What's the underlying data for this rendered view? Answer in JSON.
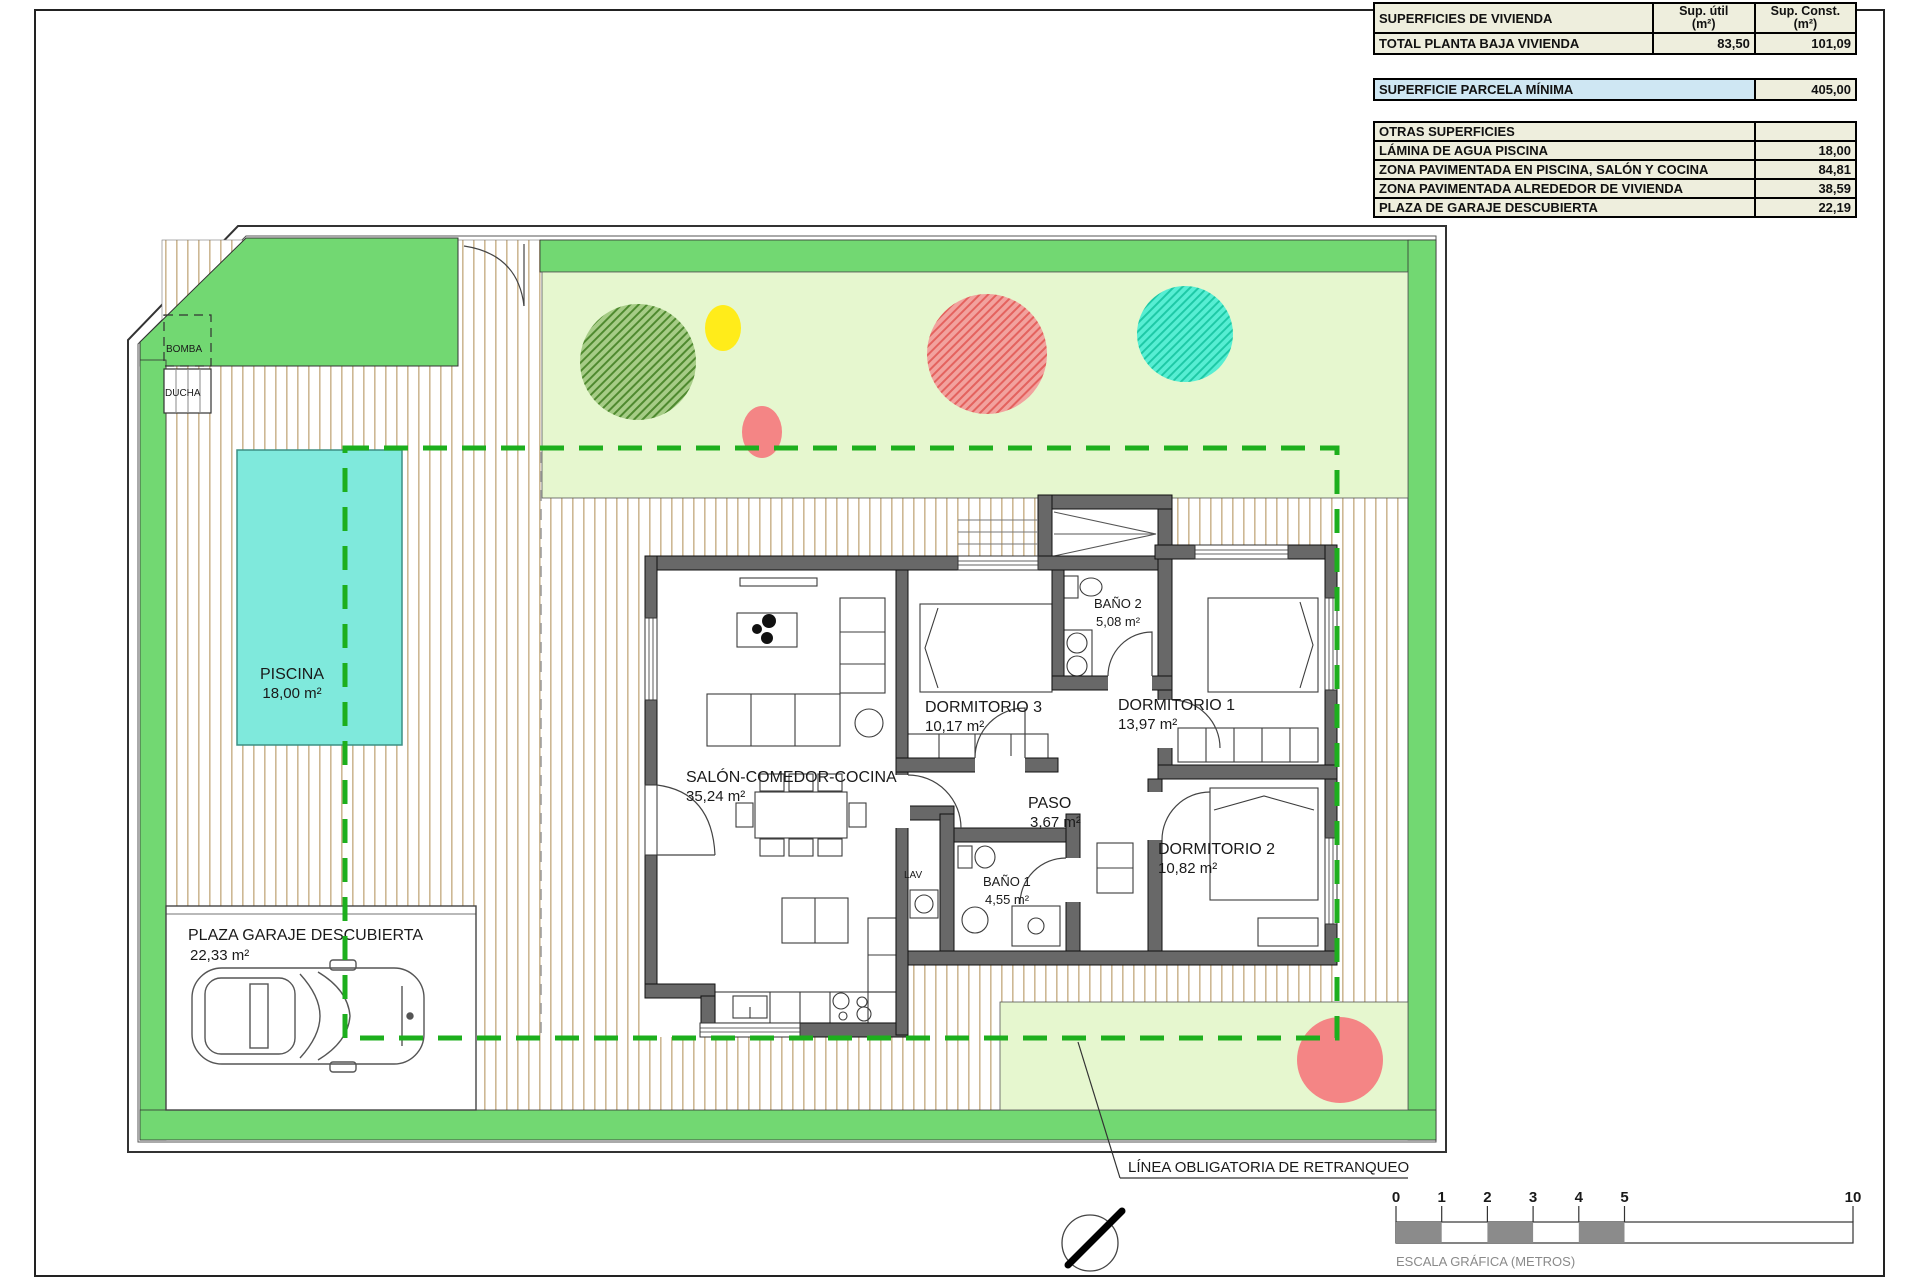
{
  "tables": {
    "vivienda": {
      "title": "SUPERFICIES DE VIVIENDA",
      "col_util_1": "Sup. útil",
      "col_util_2": "(m²)",
      "col_const_1": "Sup. Const.",
      "col_const_2": "(m²)",
      "total_label": "TOTAL PLANTA BAJA VIVIENDA",
      "total_util": "83,50",
      "total_const": "101,09"
    },
    "parcela": {
      "label": "SUPERFICIE PARCELA MÍNIMA",
      "value": "405,00"
    },
    "otras": {
      "title": "OTRAS SUPERFICIES",
      "rows": [
        {
          "label": "LÁMINA DE AGUA PISCINA",
          "value": "18,00"
        },
        {
          "label": "ZONA PAVIMENTADA EN PISCINA, SALÓN Y COCINA",
          "value": "84,81"
        },
        {
          "label": "ZONA PAVIMENTADA ALREDEDOR DE VIVIENDA",
          "value": "38,59"
        },
        {
          "label": "PLAZA DE GARAJE DESCUBIERTA",
          "value": "22,19"
        }
      ]
    }
  },
  "rooms": {
    "salon": {
      "name": "SALÓN-COMEDOR-COCINA",
      "area": "35,24 m²"
    },
    "dorm3": {
      "name": "DORMITORIO 3",
      "area": "10,17 m²"
    },
    "dorm1": {
      "name": "DORMITORIO 1",
      "area": "13,97 m²"
    },
    "dorm2": {
      "name": "DORMITORIO 2",
      "area": "10,82 m²"
    },
    "bano2": {
      "name": "BAÑO 2",
      "area": "5,08 m²"
    },
    "bano1": {
      "name": "BAÑO 1",
      "area": "4,55 m²"
    },
    "paso": {
      "name": "PASO",
      "area": "3,67 m²"
    },
    "lav": {
      "name": "LAV"
    }
  },
  "site": {
    "piscina": {
      "name": "PISCINA",
      "area": "18,00 m²"
    },
    "garaje": {
      "name": "PLAZA GARAJE DESCUBIERTA",
      "area": "22,33 m²"
    },
    "bomba": "BOMBA",
    "ducha": "DUCHA",
    "retranqueo": "LÍNEA OBLIGATORIA DE RETRANQUEO"
  },
  "scalebar": {
    "ticks": [
      "0",
      "1",
      "2",
      "3",
      "4",
      "5",
      "10"
    ],
    "label": "ESCALA GRÁFICA (METROS)"
  },
  "colors": {
    "grass": "#72d872",
    "lawn": "#e6f7cf",
    "pool": "#7fe9dc",
    "dash": "#1daf1d",
    "paving_line": "#cdb894",
    "wall": "#686868",
    "tree_green_bg": "#a6cc86",
    "tree_green_line": "#4f8a2f",
    "tree_red_bg": "#f2a29e",
    "tree_red_line": "#e4625e",
    "tree_teal_bg": "#57eed3",
    "tree_teal_line": "#1ec9a6",
    "bush_yellow": "#ffec1a",
    "bush_coral": "#f48585",
    "scale_gray": "#8b8b8b",
    "table_beige": "#eeeedd",
    "table_blue": "#cfe7f3"
  }
}
